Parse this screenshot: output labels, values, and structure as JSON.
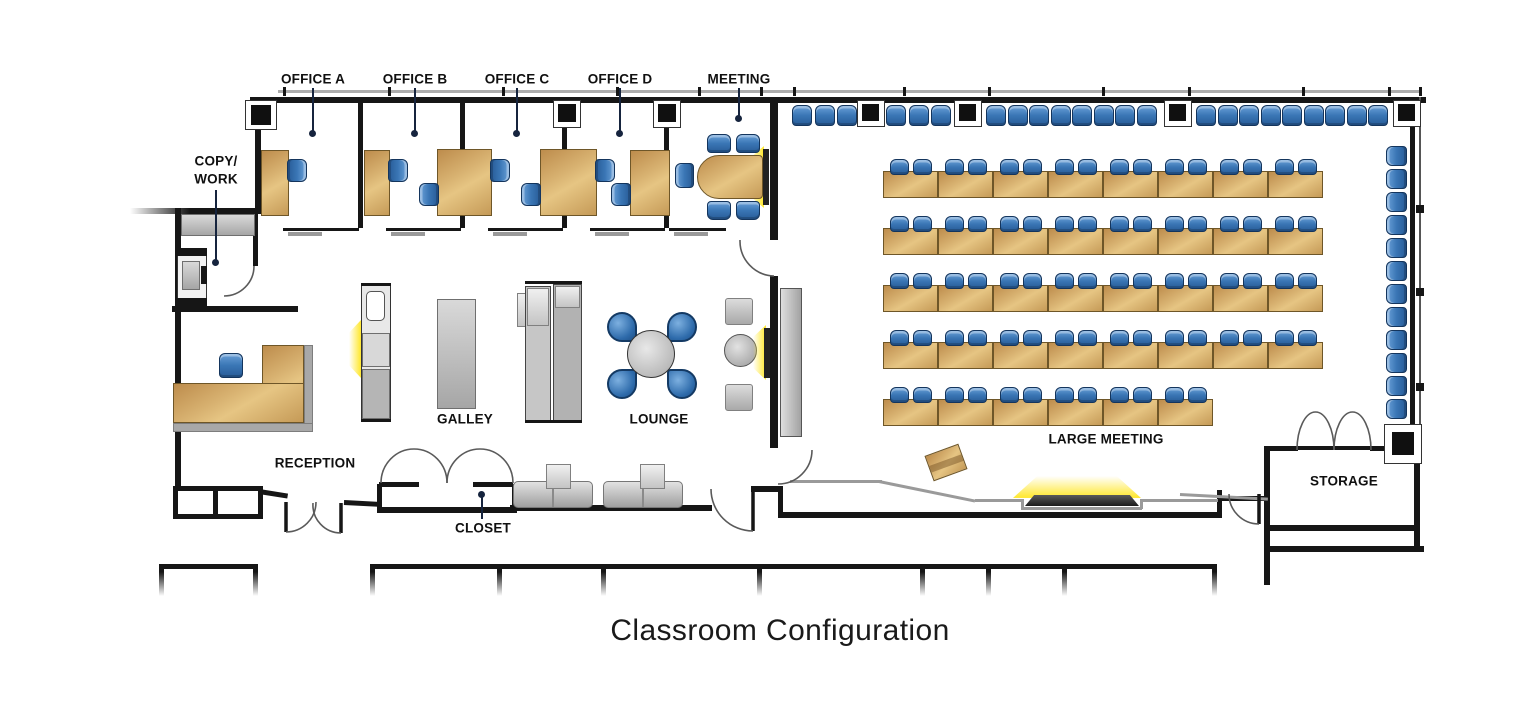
{
  "title": "Classroom Configuration",
  "rooms": {
    "office_a": {
      "label": "OFFICE A"
    },
    "office_b": {
      "label": "OFFICE B"
    },
    "office_c": {
      "label": "OFFICE C"
    },
    "office_d": {
      "label": "OFFICE D"
    },
    "meeting": {
      "label": "MEETING",
      "seats": 5
    },
    "copy_work": {
      "label_line1": "COPY/",
      "label_line2": "WORK"
    },
    "reception": {
      "label": "RECEPTION"
    },
    "galley": {
      "label": "GALLEY"
    },
    "lounge": {
      "label": "LOUNGE",
      "seats": 4
    },
    "closet": {
      "label": "CLOSET"
    },
    "large_meeting": {
      "label": "LARGE MEETING"
    },
    "storage": {
      "label": "STORAGE"
    }
  },
  "colors": {
    "wall": "#161616",
    "desk_tan": "#C99B5C",
    "chair_blue": "#3B76B4",
    "glow_yellow": "#FFE93B",
    "gray_furniture": "#B9B9B9",
    "leader_navy": "#16243E"
  },
  "classroom": {
    "table_w": 55,
    "table_h": 27,
    "table_rows": [
      {
        "x": 883,
        "y": 171,
        "tables": 8,
        "chairs_per_table": 2
      },
      {
        "x": 883,
        "y": 228,
        "tables": 8,
        "chairs_per_table": 2
      },
      {
        "x": 883,
        "y": 285,
        "tables": 8,
        "chairs_per_table": 2
      },
      {
        "x": 883,
        "y": 342,
        "tables": 8,
        "chairs_per_table": 2
      },
      {
        "x": 883,
        "y": 399,
        "tables": 6,
        "chairs_per_table": 2
      }
    ],
    "top_chair_groups": [
      {
        "x": 792,
        "count": 3,
        "pitch": 22.5
      },
      {
        "x": 886,
        "count": 3,
        "pitch": 22.5
      },
      {
        "x": 986,
        "count": 8,
        "pitch": 21.5
      },
      {
        "x": 1196,
        "count": 9,
        "pitch": 21.5
      }
    ],
    "top_column_frames_x": [
      857,
      954,
      1164,
      1393
    ],
    "right_chair_column": {
      "x": 1386,
      "y_start": 146,
      "count": 12,
      "pitch": 23
    }
  }
}
